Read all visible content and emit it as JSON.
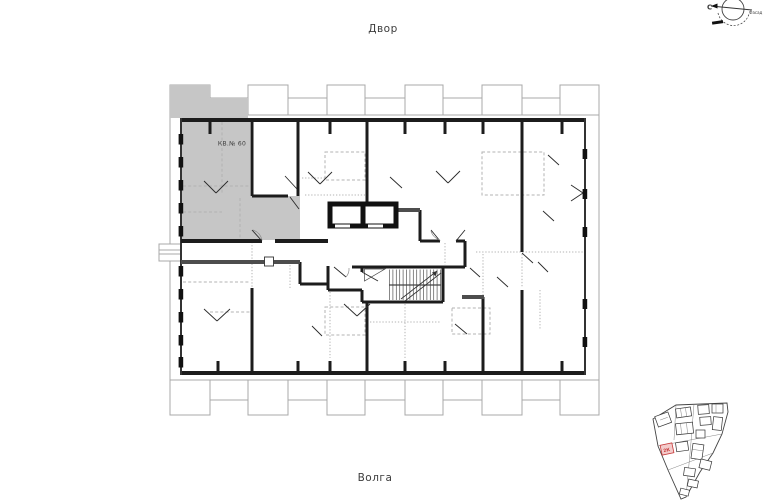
{
  "texts": {
    "courtyard": "Двор",
    "river": "Волга",
    "apartment_label": "КВ.№ 60",
    "compass_north": "С",
    "compass_note": "Фасад",
    "siteplan_highlight": "2К"
  },
  "colors": {
    "highlight_fill": "#c6c6c6",
    "wall": "#1c1c1c",
    "concrete_wall": "#4d4d4d",
    "outline": "#a8a8a8",
    "dashed": "#b3b3b3",
    "accent_red": "#c63b3b",
    "accent_red_fill": "#f3cbcb",
    "text": "#3c3c3c"
  }
}
